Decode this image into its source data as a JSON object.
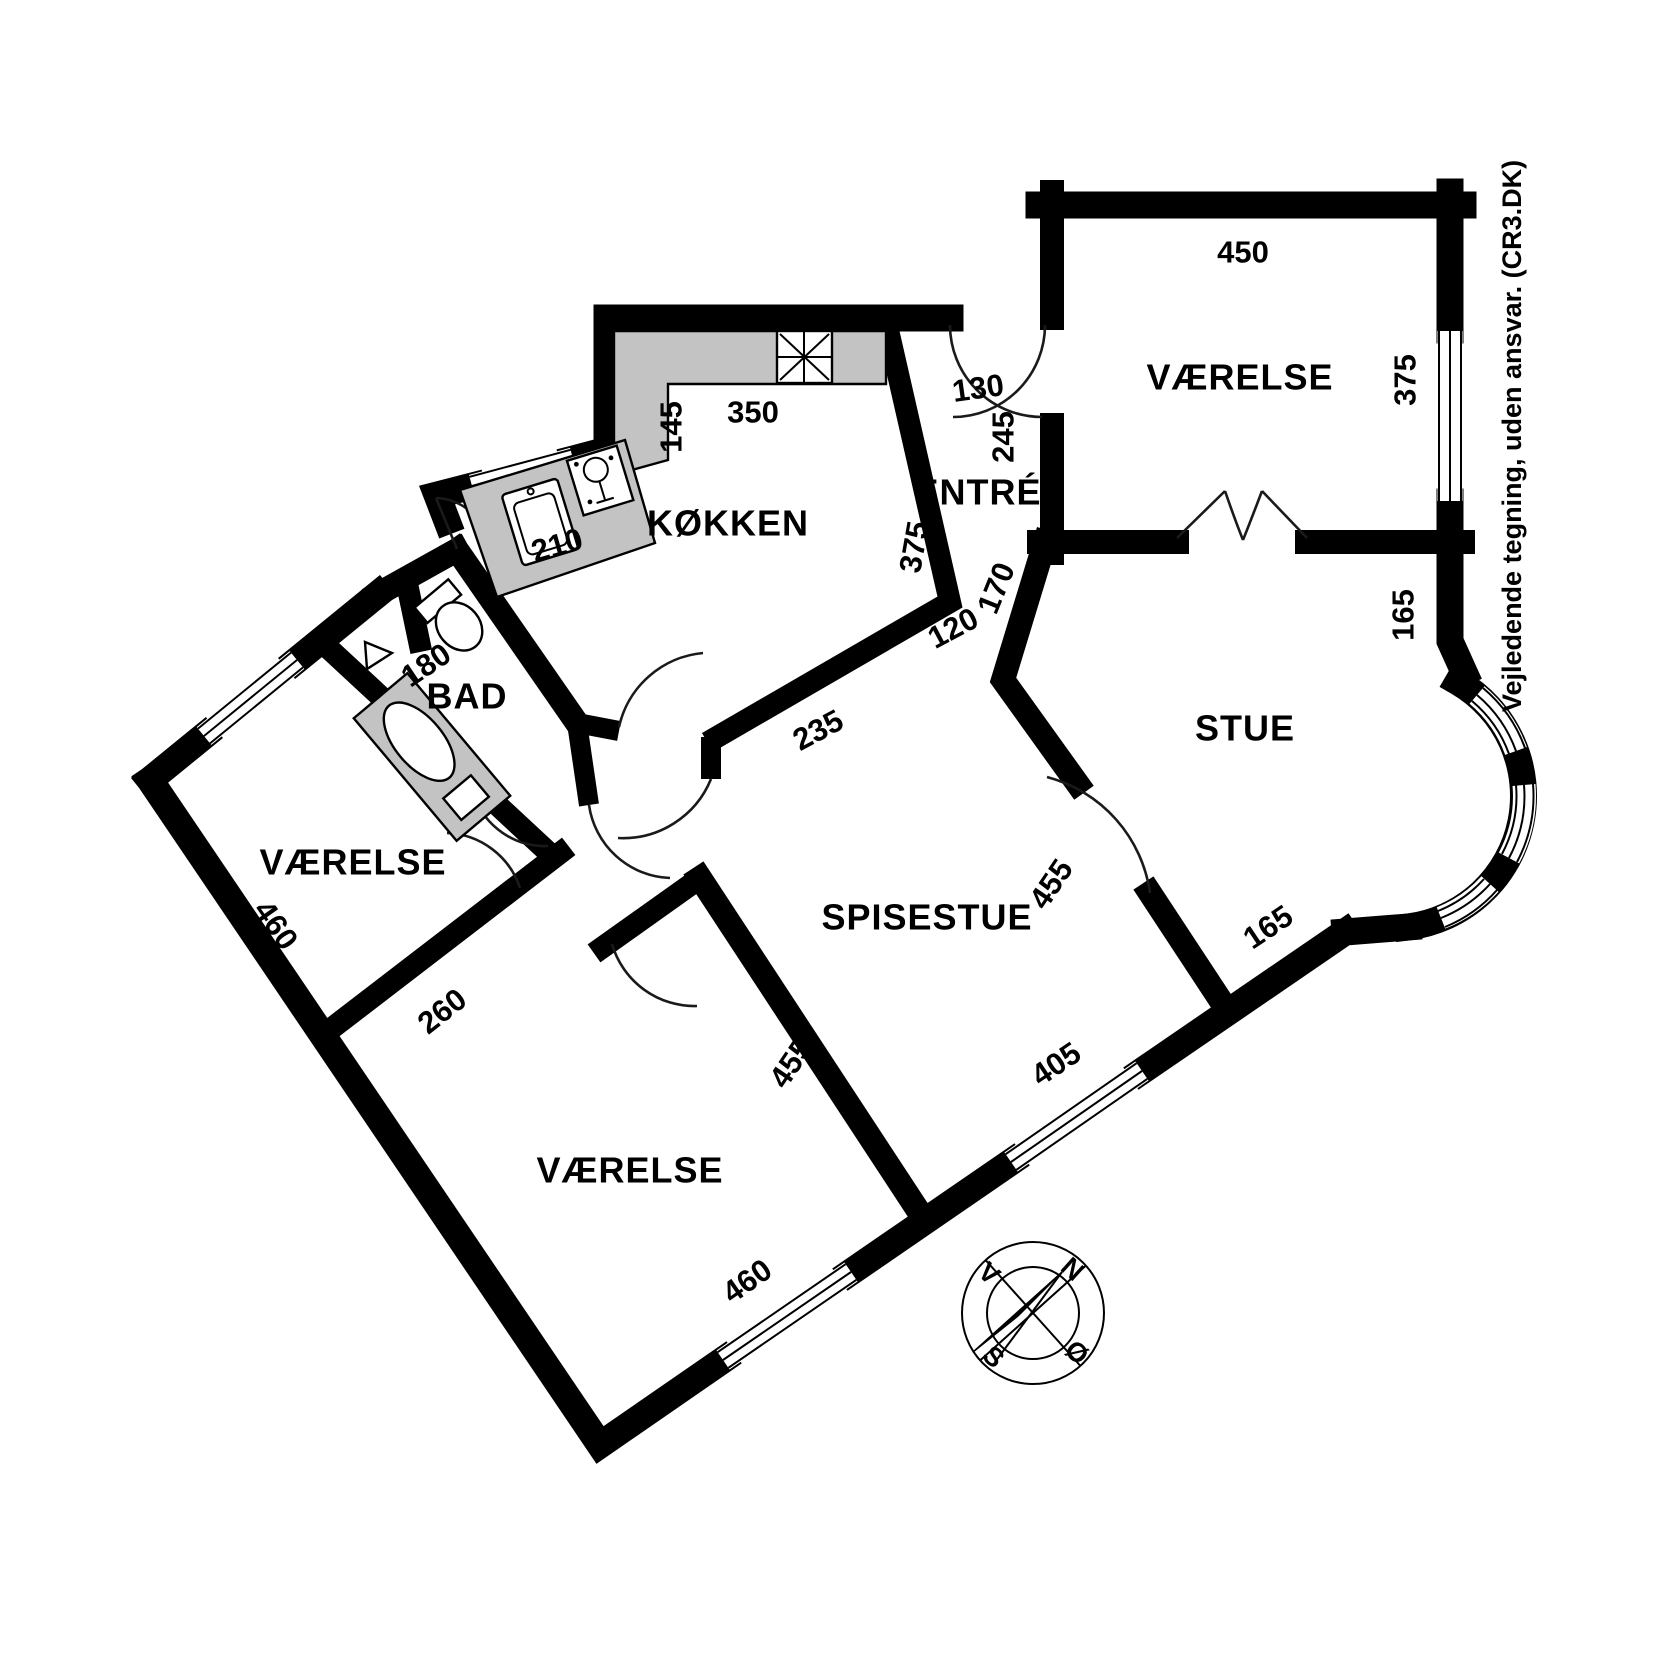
{
  "page": {
    "background": "#ffffff",
    "disclaimer": "Vejledende tegning, uden ansvar. (CR3.DK)"
  },
  "floorplan": {
    "wall_color": "#000000",
    "counter_color": "#c3c3c3",
    "rooms": [
      {
        "id": "vaerelse-ne",
        "label": "VÆRELSE",
        "x": 1240,
        "y": 377,
        "rot": 0
      },
      {
        "id": "stue",
        "label": "STUE",
        "x": 1245,
        "y": 728,
        "rot": 0
      },
      {
        "id": "entre",
        "label": "ENTRÉ",
        "x": 978,
        "y": 492,
        "rot": 0
      },
      {
        "id": "koekken",
        "label": "KØKKEN",
        "x": 728,
        "y": 523,
        "rot": 0
      },
      {
        "id": "bad",
        "label": "BAD",
        "x": 467,
        "y": 696,
        "rot": 0
      },
      {
        "id": "vaerelse-w",
        "label": "VÆRELSE",
        "x": 353,
        "y": 862,
        "rot": 0
      },
      {
        "id": "spisestue",
        "label": "SPISESTUE",
        "x": 927,
        "y": 917,
        "rot": 0
      },
      {
        "id": "vaerelse-s",
        "label": "VÆRELSE",
        "x": 630,
        "y": 1170,
        "rot": 0
      }
    ],
    "dimensions": [
      {
        "v": "450",
        "x": 1243,
        "y": 252,
        "r": 0
      },
      {
        "v": "375",
        "x": 1405,
        "y": 380,
        "r": -90
      },
      {
        "v": "165",
        "x": 1403,
        "y": 615,
        "r": -90
      },
      {
        "v": "130",
        "x": 978,
        "y": 388,
        "r": -8
      },
      {
        "v": "245",
        "x": 1003,
        "y": 437,
        "r": -90
      },
      {
        "v": "350",
        "x": 753,
        "y": 412,
        "r": 0
      },
      {
        "v": "145",
        "x": 671,
        "y": 427,
        "r": -90
      },
      {
        "v": "210",
        "x": 557,
        "y": 545,
        "r": -16
      },
      {
        "v": "375",
        "x": 914,
        "y": 547,
        "r": -80
      },
      {
        "v": "170",
        "x": 996,
        "y": 588,
        "r": -68
      },
      {
        "v": "120",
        "x": 953,
        "y": 628,
        "r": -28
      },
      {
        "v": "235",
        "x": 818,
        "y": 730,
        "r": -28
      },
      {
        "v": "455",
        "x": 1051,
        "y": 884,
        "r": -56
      },
      {
        "v": "455",
        "x": 791,
        "y": 1063,
        "r": -56
      },
      {
        "v": "405",
        "x": 1056,
        "y": 1064,
        "r": -34
      },
      {
        "v": "165",
        "x": 1268,
        "y": 927,
        "r": -34
      },
      {
        "v": "460",
        "x": 747,
        "y": 1281,
        "r": -35
      },
      {
        "v": "460",
        "x": 276,
        "y": 925,
        "r": 55
      },
      {
        "v": "260",
        "x": 442,
        "y": 1011,
        "r": -38
      },
      {
        "v": "180",
        "x": 426,
        "y": 665,
        "r": -34
      }
    ],
    "compass": {
      "cx": 1033,
      "cy": 1313,
      "rotation": 42,
      "letter_radius": 59,
      "points": [
        {
          "label": "N",
          "angle": -48
        },
        {
          "label": "Ø",
          "angle": 42
        },
        {
          "label": "S",
          "angle": 132
        },
        {
          "label": "V",
          "angle": -138
        }
      ]
    }
  }
}
